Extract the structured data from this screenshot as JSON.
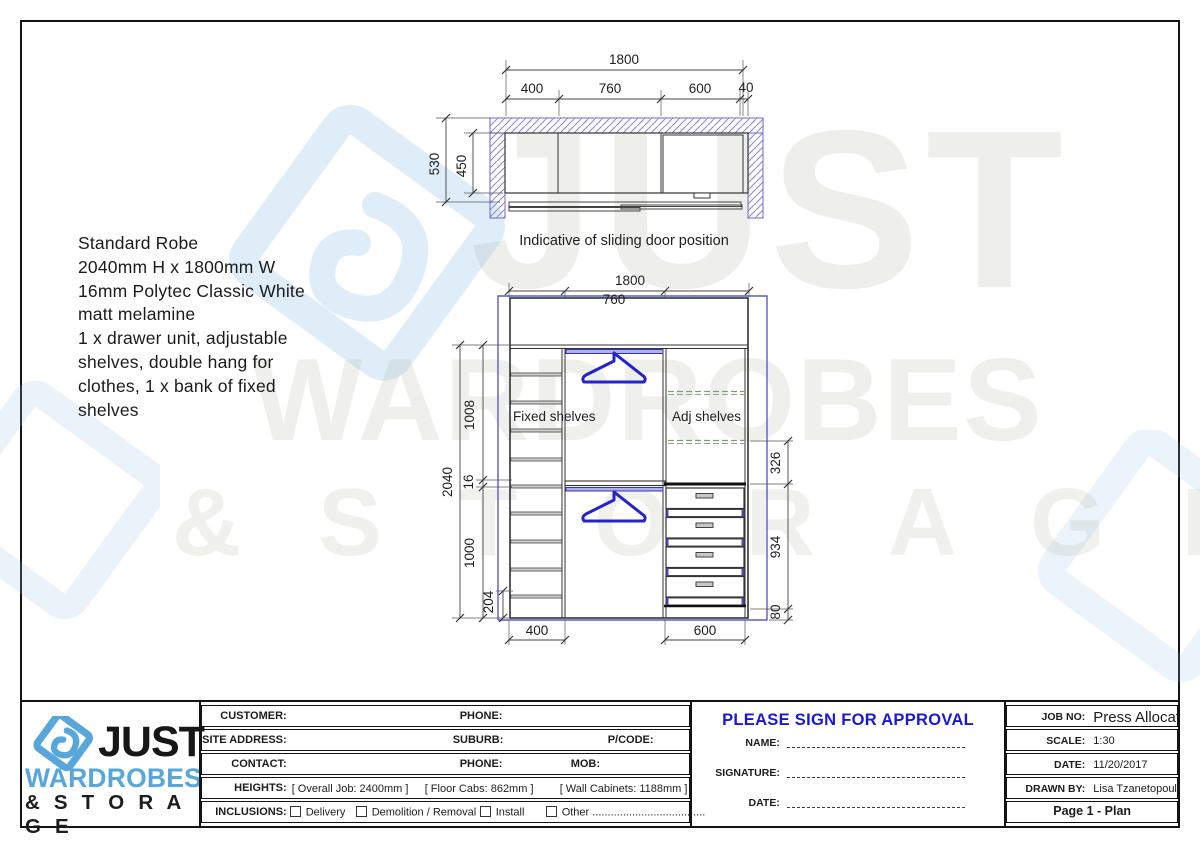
{
  "description": {
    "lines": [
      "Standard Robe",
      "2040mm H x 1800mm W",
      "16mm Polytec Classic White",
      "matt melamine",
      "1 x drawer unit, adjustable",
      "shelves, double hang for",
      "clothes, 1 x bank of fixed",
      "shelves"
    ]
  },
  "plan": {
    "caption": "Indicative of sliding door position",
    "dim_total": "1800",
    "dim_400": "400",
    "dim_760": "760",
    "dim_600": "600",
    "dim_40": "40",
    "dim_530": "530",
    "dim_450": "450"
  },
  "elevation": {
    "dim_width": "1800",
    "dim_mid": "760",
    "dim_height": "2040",
    "dim_1008": "1008",
    "dim_16": "16",
    "dim_1000": "1000",
    "dim_204": "204",
    "dim_326": "326",
    "dim_934": "934",
    "dim_80": "80",
    "dim_b400": "400",
    "dim_b600": "600",
    "label_fixed": "Fixed shelves",
    "label_adj": "Adj shelves"
  },
  "watermark": {
    "line1": "JUST",
    "line2": "WARDROBES",
    "line3": "& S T O R A G E"
  },
  "logo": {
    "word1": "JUST",
    "word2": "WARDROBES",
    "word3": "& S T O R A G E"
  },
  "title_block": {
    "customer_label": "CUSTOMER:",
    "phone1_label": "PHONE:",
    "site_label": "SITE ADDRESS:",
    "suburb_label": "SUBURB:",
    "pcode_label": "P/CODE:",
    "contact_label": "CONTACT:",
    "phone2_label": "PHONE:",
    "mob_label": "MOB:",
    "heights_label": "HEIGHTS:",
    "heights_overall": "[ Overall Job: 2400mm ]",
    "heights_floor": "[ Floor Cabs: 862mm ]",
    "heights_wall": "[ Wall Cabinets: 1188mm ]",
    "inclusions_label": "INCLUSIONS:",
    "inc_delivery": "Delivery",
    "inc_demolition": "Demolition / Removal",
    "inc_install": "Install",
    "inc_other": "Other ....................................."
  },
  "approval": {
    "heading": "PLEASE SIGN FOR APPROVAL",
    "name_label": "NAME:",
    "signature_label": "SIGNATURE:",
    "date_label": "DATE:"
  },
  "info": {
    "job_no_label": "JOB NO:",
    "job_no_value": "Press Allocate to a",
    "scale_label": "SCALE:",
    "scale_value": "1:30",
    "date_label": "DATE:",
    "date_value": "11/20/2017",
    "drawn_label": "DRAWN BY:",
    "drawn_value": "Lisa Tzanetopoulos",
    "page_label": "Page 1 - Plan"
  }
}
